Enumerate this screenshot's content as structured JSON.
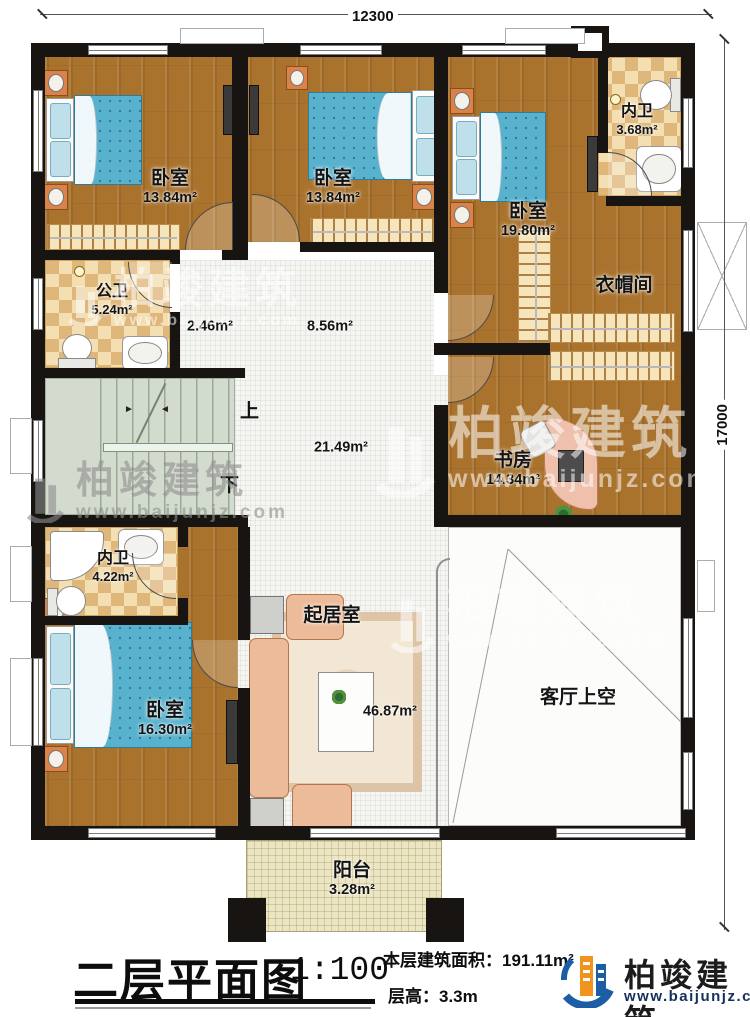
{
  "dims": {
    "width": "12300",
    "height": "17000"
  },
  "rooms": {
    "bedroom1": {
      "label": "卧室",
      "area": "13.84m²"
    },
    "bedroom2": {
      "label": "卧室",
      "area": "13.84m²"
    },
    "bedroom3": {
      "label": "卧室",
      "area": "19.80m²"
    },
    "bath_top": {
      "label": "内卫",
      "area": "3.68m²"
    },
    "public_bath": {
      "label": "公卫",
      "area": "5.24m²"
    },
    "hall_small": {
      "area": "2.46m²"
    },
    "hall_mid": {
      "area": "8.56m²"
    },
    "hall_main": {
      "area": "21.49m²"
    },
    "cloakroom": {
      "label": "衣帽间"
    },
    "study": {
      "label": "书房",
      "area": "14.34m²"
    },
    "bath_bottom": {
      "label": "内卫",
      "area": "4.22m²"
    },
    "bedroom4": {
      "label": "卧室",
      "area": "16.30m²"
    },
    "living": {
      "label": "起居室",
      "area": "46.87m²"
    },
    "void": {
      "label": "客厅上空"
    },
    "balcony": {
      "label": "阳台",
      "area": "3.28m²"
    }
  },
  "stairs": {
    "up": "上",
    "down": "下"
  },
  "icons": {
    "stair_arrow_right": "►",
    "stair_arrow_left": "◄"
  },
  "title_block": {
    "title": "二层平面图",
    "scale": "1:100",
    "area_text": "本层建筑面积：191.11m²",
    "height_text": "层高：3.3m"
  },
  "brand": {
    "name": "柏竣建筑",
    "url": "www.baijunjz.com"
  },
  "colors": {
    "wall": "#171412",
    "wood": "#a9732e",
    "checker_light": "#f3dfb2",
    "checker_dark": "#dfb77b",
    "stairs": "#d2dbcd",
    "hall": "#f5f5f1",
    "balcony": "#ebe5c3",
    "mattress": "#58b2ce",
    "brand_blue": "#1b5ea6",
    "brand_orange": "#f0941d"
  }
}
